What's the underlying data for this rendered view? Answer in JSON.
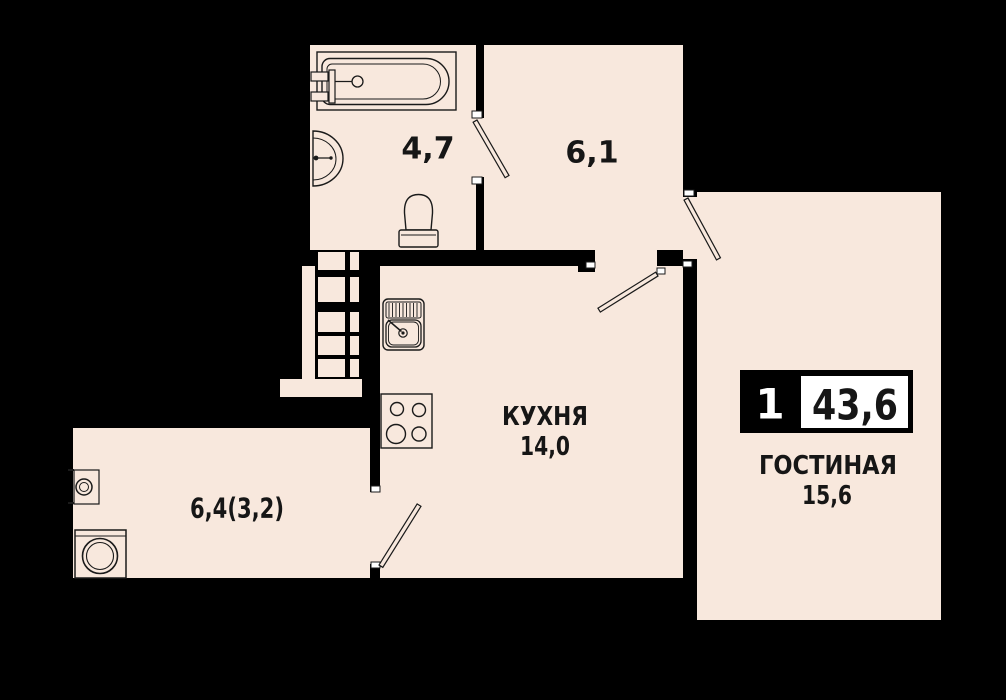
{
  "colors": {
    "background": "#000000",
    "floor": "#f8e8dd",
    "walls": "#000000",
    "line": "#1a1a1a",
    "text": "#161616",
    "badge_bg": "#000000",
    "badge_box": "#ffffff",
    "badge_text_light": "#ffffff",
    "badge_text_dark": "#111111"
  },
  "rooms": {
    "bathroom": {
      "area": "4,7"
    },
    "hallway": {
      "area": "6,1"
    },
    "kitchen": {
      "name": "КУХНЯ",
      "area": "14,0"
    },
    "living": {
      "name": "ГОСТИНАЯ",
      "area": "15,6"
    },
    "balcony": {
      "area": "6,4(3,2)"
    }
  },
  "badge": {
    "room_count": "1",
    "total_area": "43,6"
  },
  "fixtures": [
    "bathtub-icon",
    "bath-sink-icon",
    "toilet-icon",
    "kitchen-sink-icon",
    "stove-icon",
    "washing-machine-icon",
    "balcony-drain-icon",
    "balcony-ladder-icon"
  ],
  "doors": [
    "bathroom-door",
    "hall-kitchen-door",
    "hall-living-door",
    "kitchen-balcony-door"
  ]
}
